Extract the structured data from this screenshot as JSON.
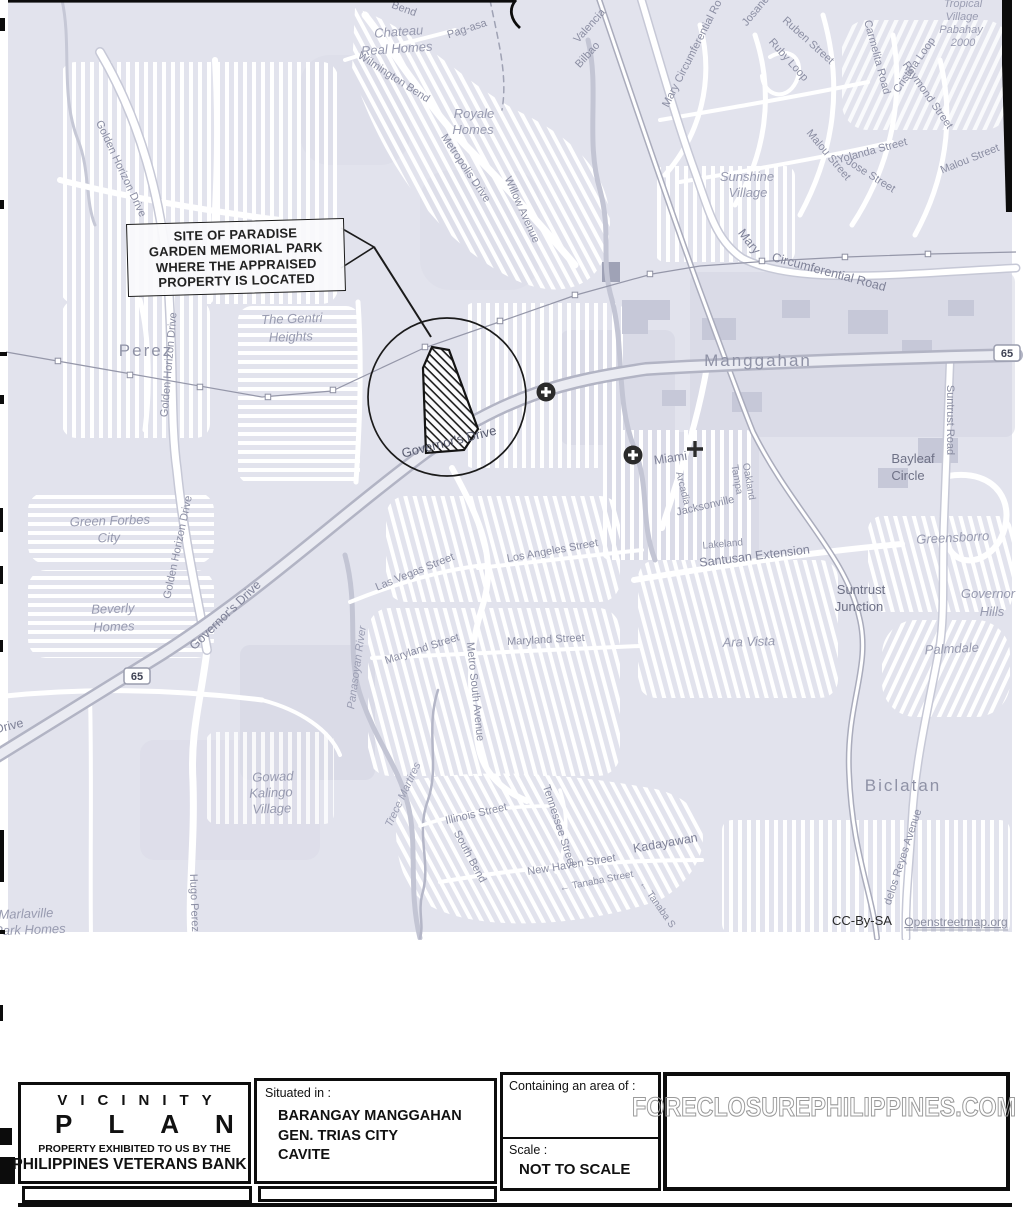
{
  "colors": {
    "map_bg": "#e2e3ed",
    "road": "#ffffff",
    "casing": "#c7c9d6",
    "street_label": "#8b8ea3",
    "ink": "#1a1a1a",
    "watermark_stroke": "#9a9a9a"
  },
  "map": {
    "callout": [
      "SITE OF PARADISE",
      "GARDEN MEMORIAL PARK",
      "WHERE THE APPRAISED",
      "PROPERTY IS LOCATED"
    ],
    "badges": [
      {
        "n": "route-65-west",
        "t": "65",
        "x": 137,
        "y": 676
      },
      {
        "n": "route-65-east",
        "t": "65",
        "x": 1007,
        "y": 353
      }
    ],
    "labels": [
      {
        "n": "bend-fragment",
        "t": "Bend",
        "x": 403,
        "y": 12,
        "r": 20,
        "c": "st"
      },
      {
        "n": "chateau-real-homes-1",
        "t": "Chateau",
        "x": 399,
        "y": 36,
        "r": -4,
        "c": "pl"
      },
      {
        "n": "chateau-real-homes-2",
        "t": "Real Homes",
        "x": 397,
        "y": 53,
        "r": -4,
        "c": "pl"
      },
      {
        "n": "pag-asa",
        "t": "Pag-asa",
        "x": 468,
        "y": 32,
        "r": -18,
        "c": "st"
      },
      {
        "n": "wilmington-bend",
        "t": "Wilmington Bend",
        "x": 392,
        "y": 80,
        "r": 33,
        "c": "st"
      },
      {
        "n": "royale-homes-1",
        "t": "Royale",
        "x": 474,
        "y": 118,
        "r": 0,
        "c": "pl"
      },
      {
        "n": "royale-homes-2",
        "t": "Homes",
        "x": 473,
        "y": 134,
        "r": 0,
        "c": "pl"
      },
      {
        "n": "metropolis-drive",
        "t": "Metropolis Drive",
        "x": 463,
        "y": 170,
        "r": 56,
        "c": "st"
      },
      {
        "n": "willow-avenue",
        "t": "Willow Avenue",
        "x": 519,
        "y": 211,
        "r": 66,
        "c": "st"
      },
      {
        "n": "valencia",
        "t": "Valencia",
        "x": 592,
        "y": 28,
        "r": -48,
        "c": "st"
      },
      {
        "n": "bilbao",
        "t": "Bilbao",
        "x": 590,
        "y": 57,
        "r": -48,
        "c": "st"
      },
      {
        "n": "mary-circumferential-road-upper",
        "t": "Mary Circumferential Ro",
        "x": 695,
        "y": 55,
        "r": -63,
        "c": "st"
      },
      {
        "n": "josane",
        "t": "Josane",
        "x": 758,
        "y": 13,
        "r": -50,
        "c": "st"
      },
      {
        "n": "ruben-street",
        "t": "Ruben Street",
        "x": 806,
        "y": 43,
        "r": 42,
        "c": "st"
      },
      {
        "n": "ruby-loop",
        "t": "Ruby Loop",
        "x": 786,
        "y": 62,
        "r": 48,
        "c": "st"
      },
      {
        "n": "carmelita-road",
        "t": "Carmelita Road",
        "x": 874,
        "y": 58,
        "r": 75,
        "c": "st"
      },
      {
        "n": "cristina-loop",
        "t": "Cristina Loop",
        "x": 917,
        "y": 67,
        "r": -55,
        "c": "st"
      },
      {
        "n": "raymond-street",
        "t": "Raymond Street",
        "x": 925,
        "y": 97,
        "r": 55,
        "c": "st"
      },
      {
        "n": "tropical-village-1",
        "t": "Tropical",
        "x": 963,
        "y": 7,
        "r": 0,
        "c": "pl2"
      },
      {
        "n": "tropical-village-2",
        "t": "Village",
        "x": 962,
        "y": 20,
        "r": 0,
        "c": "pl2"
      },
      {
        "n": "tropical-village-3",
        "t": "Pabahay",
        "x": 961,
        "y": 33,
        "r": 0,
        "c": "pl2"
      },
      {
        "n": "tropical-village-4",
        "t": "2000",
        "x": 963,
        "y": 46,
        "r": 0,
        "c": "pl2"
      },
      {
        "n": "malou-street-west",
        "t": "Malou Street",
        "x": 826,
        "y": 157,
        "r": 50,
        "c": "st"
      },
      {
        "n": "yolanda-street",
        "t": "Yolanda Street",
        "x": 873,
        "y": 154,
        "r": -15,
        "c": "st"
      },
      {
        "n": "jose-street",
        "t": "Jose Street",
        "x": 869,
        "y": 178,
        "r": 32,
        "c": "st"
      },
      {
        "n": "malou-street-east",
        "t": "Malou Street",
        "x": 971,
        "y": 162,
        "r": -22,
        "c": "st"
      },
      {
        "n": "sunshine-village-1",
        "t": "Sunshine",
        "x": 747,
        "y": 181,
        "r": 0,
        "c": "pl"
      },
      {
        "n": "sunshine-village-2",
        "t": "Village",
        "x": 748,
        "y": 197,
        "r": 0,
        "c": "pl"
      },
      {
        "n": "mary-circumferential-road-bend",
        "t": "Mary",
        "x": 746,
        "y": 244,
        "r": 52,
        "c": "st3"
      },
      {
        "n": "mary-circumferential-road-lower",
        "t": "Circumferential Road",
        "x": 828,
        "y": 276,
        "r": 15,
        "c": "st3"
      },
      {
        "n": "manggahan",
        "t": "Manggahan",
        "x": 758,
        "y": 366,
        "r": 0,
        "c": "big"
      },
      {
        "n": "suntrust-road",
        "t": "Suntrust Road",
        "x": 947,
        "y": 420,
        "r": 90,
        "c": "st"
      },
      {
        "n": "bayleaf-circle-1",
        "t": "Bayleaf",
        "x": 913,
        "y": 463,
        "r": 0,
        "c": "sub"
      },
      {
        "n": "bayleaf-circle-2",
        "t": "Circle",
        "x": 908,
        "y": 480,
        "r": 0,
        "c": "sub"
      },
      {
        "n": "miami",
        "t": "Miami",
        "x": 671,
        "y": 462,
        "r": -8,
        "c": "st3"
      },
      {
        "n": "oakland",
        "t": "Oakland",
        "x": 746,
        "y": 482,
        "r": 80,
        "c": "st2"
      },
      {
        "n": "tampa",
        "t": "Tampa",
        "x": 734,
        "y": 480,
        "r": 80,
        "c": "st2"
      },
      {
        "n": "arcadia",
        "t": "Arcadia",
        "x": 680,
        "y": 489,
        "r": 76,
        "c": "st2"
      },
      {
        "n": "jacksonville",
        "t": "Jacksonville",
        "x": 706,
        "y": 509,
        "r": -13,
        "c": "st"
      },
      {
        "n": "lakeland",
        "t": "Lakeland",
        "x": 723,
        "y": 547,
        "r": -5,
        "c": "st2"
      },
      {
        "n": "santusan-extension",
        "t": "Santusan Extension",
        "x": 755,
        "y": 560,
        "r": -7,
        "c": "st3"
      },
      {
        "n": "greensborro",
        "t": "Greensborro",
        "x": 953,
        "y": 542,
        "r": -3,
        "c": "pl"
      },
      {
        "n": "suntrust-junction-1",
        "t": "Suntrust",
        "x": 861,
        "y": 594,
        "r": 0,
        "c": "sub"
      },
      {
        "n": "suntrust-junction-2",
        "t": "Junction",
        "x": 859,
        "y": 611,
        "r": 0,
        "c": "sub"
      },
      {
        "n": "governor-hills-1",
        "t": "Governor",
        "x": 988,
        "y": 598,
        "r": 0,
        "c": "pl"
      },
      {
        "n": "governor-hills-2",
        "t": "Hills",
        "x": 992,
        "y": 616,
        "r": 0,
        "c": "pl"
      },
      {
        "n": "ara-vista",
        "t": "Ara Vista",
        "x": 749,
        "y": 646,
        "r": -2,
        "c": "pl"
      },
      {
        "n": "palmdale",
        "t": "Palmdale",
        "x": 952,
        "y": 653,
        "r": -3,
        "c": "pl"
      },
      {
        "n": "green-forbes-city-1",
        "t": "Green Forbes",
        "x": 110,
        "y": 525,
        "r": -2,
        "c": "pl"
      },
      {
        "n": "green-forbes-city-2",
        "t": "City",
        "x": 109,
        "y": 542,
        "r": -2,
        "c": "pl"
      },
      {
        "n": "beverly-homes-1",
        "t": "Beverly",
        "x": 113,
        "y": 613,
        "r": -2,
        "c": "pl"
      },
      {
        "n": "beverly-homes-2",
        "t": "Homes",
        "x": 114,
        "y": 631,
        "r": -2,
        "c": "pl"
      },
      {
        "n": "golden-horizon-drive-north",
        "t": "Golden Horizon Drive",
        "x": 118,
        "y": 170,
        "r": 65,
        "c": "st"
      },
      {
        "n": "golden-horizon-drive-mid",
        "t": "Golden Horizon Drive",
        "x": 172,
        "y": 365,
        "r": -85,
        "c": "st"
      },
      {
        "n": "golden-horizon-drive-south",
        "t": "Golden Horizon Drive",
        "x": 181,
        "y": 548,
        "r": -78,
        "c": "st"
      },
      {
        "n": "perez",
        "t": "Perez",
        "x": 146,
        "y": 356,
        "r": 0,
        "c": "big"
      },
      {
        "n": "the-gentri-heights-1",
        "t": "The Gentri",
        "x": 292,
        "y": 323,
        "r": -2,
        "c": "pl"
      },
      {
        "n": "the-gentri-heights-2",
        "t": "Heights",
        "x": 291,
        "y": 341,
        "r": -2,
        "c": "pl"
      },
      {
        "n": "governors-drive-sw",
        "t": "Governor's Drive",
        "x": 228,
        "y": 618,
        "r": -44,
        "c": "st3"
      },
      {
        "n": "governors-drive-site",
        "t": "Governor's Drive",
        "x": 450,
        "y": 446,
        "r": -14,
        "c": "gov"
      },
      {
        "n": "drive-fragment",
        "t": "Drive",
        "x": 10,
        "y": 730,
        "r": -14,
        "c": "st3"
      },
      {
        "n": "gowad-village-1",
        "t": "Gowad",
        "x": 273,
        "y": 781,
        "r": -2,
        "c": "pl"
      },
      {
        "n": "gowad-village-2",
        "t": "Kalingo",
        "x": 271,
        "y": 797,
        "r": -2,
        "c": "pl"
      },
      {
        "n": "gowad-village-3",
        "t": "Village",
        "x": 272,
        "y": 813,
        "r": -2,
        "c": "pl"
      },
      {
        "n": "hugo-perez",
        "t": "Hugo Perez",
        "x": 191,
        "y": 903,
        "r": 88,
        "c": "st"
      },
      {
        "n": "panasoyan-river",
        "t": "Panasoyan River",
        "x": 360,
        "y": 668,
        "r": -82,
        "c": "pl2"
      },
      {
        "n": "trece-martires",
        "t": "Trece Martires",
        "x": 406,
        "y": 796,
        "r": -65,
        "c": "pl2"
      },
      {
        "n": "las-vegas-street",
        "t": "Las Vegas Street",
        "x": 416,
        "y": 575,
        "r": -22,
        "c": "st"
      },
      {
        "n": "los-angeles-street",
        "t": "Los Angeles Street",
        "x": 553,
        "y": 554,
        "r": -10,
        "c": "st"
      },
      {
        "n": "maryland-street-west",
        "t": "Maryland Street",
        "x": 423,
        "y": 652,
        "r": -18,
        "c": "st"
      },
      {
        "n": "maryland-street-east",
        "t": "Maryland Street",
        "x": 546,
        "y": 643,
        "r": -3,
        "c": "st"
      },
      {
        "n": "metro-south-avenue",
        "t": "Metro South Avenue",
        "x": 472,
        "y": 692,
        "r": 84,
        "c": "st"
      },
      {
        "n": "illinois-street",
        "t": "Illinois Street",
        "x": 477,
        "y": 817,
        "r": -13,
        "c": "st"
      },
      {
        "n": "south-bend",
        "t": "South Bend",
        "x": 467,
        "y": 858,
        "r": 62,
        "c": "st"
      },
      {
        "n": "tennessee-street",
        "t": "Tennessee Street",
        "x": 556,
        "y": 827,
        "r": 72,
        "c": "st"
      },
      {
        "n": "new-haven-street",
        "t": "New Haven Street",
        "x": 572,
        "y": 868,
        "r": -9,
        "c": "st"
      },
      {
        "n": "tanaba-street-west",
        "t": "← Tanaba Street",
        "x": 597,
        "y": 884,
        "r": -11,
        "c": "st2"
      },
      {
        "n": "tanaba-street-south",
        "t": "← Tanaba S",
        "x": 655,
        "y": 906,
        "r": 55,
        "c": "st2"
      },
      {
        "n": "kadayawan",
        "t": "Kadayawan",
        "x": 666,
        "y": 847,
        "r": -10,
        "c": "st3"
      },
      {
        "n": "biclatan",
        "t": "Biclatan",
        "x": 903,
        "y": 791,
        "r": 0,
        "c": "big"
      },
      {
        "n": "delos-reyes-avenue",
        "t": "delos Reyes Avenue",
        "x": 906,
        "y": 858,
        "r": -72,
        "c": "st"
      },
      {
        "n": "marlaville-1",
        "t": "Marlaville",
        "x": 26,
        "y": 918,
        "r": -2,
        "c": "pl"
      },
      {
        "n": "marlaville-2",
        "t": "Park Homes",
        "x": 30,
        "y": 934,
        "r": -2,
        "c": "pl"
      },
      {
        "n": "cc-by-sa",
        "t": "CC-By-SA",
        "x": 862,
        "y": 925,
        "r": 0,
        "c": "blk"
      },
      {
        "n": "openstreetmap-link",
        "t": "Openstreetmap.org",
        "x": 956,
        "y": 926,
        "r": 0,
        "c": "lnk"
      }
    ]
  },
  "titleblock": {
    "title_row1": "VICINITY",
    "title_row2": "PLAN",
    "exhibited_line1": "PROPERTY EXHIBITED TO US BY THE",
    "exhibited_line2": "PHILIPPINES VETERANS BANK",
    "situated_label": "Situated in :",
    "situated_line1": "BARANGAY MANGGAHAN",
    "situated_line2": "GEN. TRIAS CITY",
    "situated_line3": "CAVITE",
    "area_label": "Containing an area of :",
    "scale_label": "Scale :",
    "scale_value": "NOT TO SCALE",
    "watermark": "FORECLOSUREPHILIPPINES.COM"
  }
}
